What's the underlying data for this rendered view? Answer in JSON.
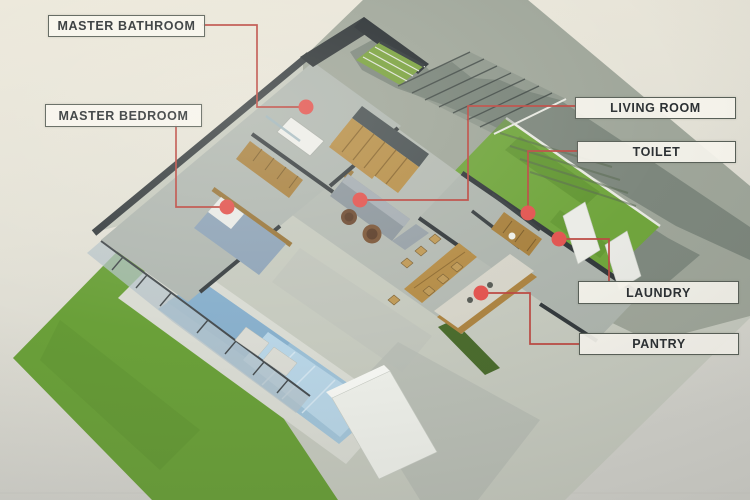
{
  "figure": {
    "kind": "isometric-house-floor-plan-callout-diagram"
  },
  "labels": [
    {
      "id": "master-bathroom",
      "text": "MASTER BATHROOM"
    },
    {
      "id": "master-bedroom",
      "text": "MASTER BEDROOM"
    },
    {
      "id": "living-room",
      "text": "LIVING ROOM"
    },
    {
      "id": "toilet",
      "text": "TOILET"
    },
    {
      "id": "laundry",
      "text": "LAUNDRY"
    },
    {
      "id": "pantry",
      "text": "PANTRY"
    }
  ],
  "colors": {
    "marker_dot": "#e25551",
    "leader_line": "#bc4a43",
    "label_background": "#f7f5ee",
    "label_border": "#596058",
    "label_text": "#2b3033",
    "lawn_green": "#6aa039",
    "right_lawn_green": "#70a53d",
    "pool_blue": "#9cc0d7",
    "wood_brown": "#b58d48",
    "wall_dark": "#3a4043",
    "shadow_gray": "#79847a",
    "paper_beige": "#e7e4d8"
  }
}
